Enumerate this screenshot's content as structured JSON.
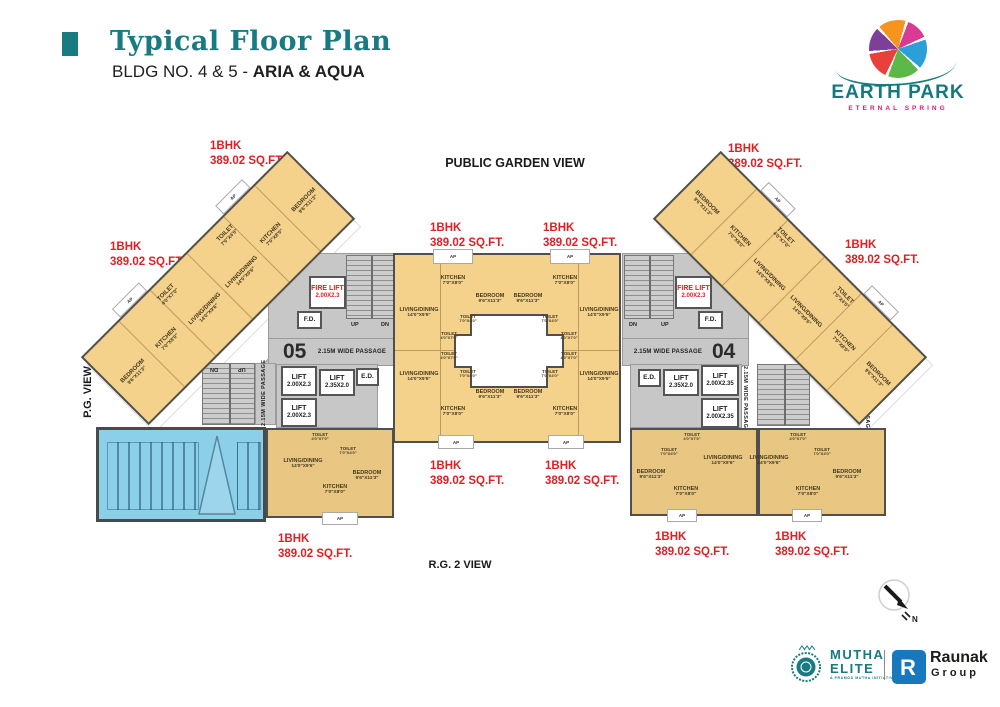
{
  "header": {
    "title": "Typical Floor Plan",
    "subtitle_prefix": "BLDG NO. 4 & 5 - ",
    "subtitle_bold": "ARIA & AQUA"
  },
  "brand": {
    "name": "EARTH PARK",
    "tagline": "ETERNAL SPRING"
  },
  "views": {
    "top": "PUBLIC GARDEN VIEW",
    "left": "P.G. VIEW",
    "bottom": "R.G. 2 VIEW"
  },
  "unit_label": {
    "type": "1BHK",
    "area": "389.02 SQ.FT."
  },
  "rooms": {
    "kitchen": {
      "name": "KITCHEN",
      "dims": "7'0\"X8'0\""
    },
    "bedroom": {
      "name": "BEDROOM",
      "dims": "9'6\"X11'3\""
    },
    "living": {
      "name": "LIVING/DINING",
      "dims": "14'0\"X9'6\""
    },
    "toilet_h": {
      "name": "TOILET",
      "dims": "7'0\"X4'0\""
    },
    "toilet_v": {
      "name": "TOILET",
      "dims": "4'0\"X7'0\""
    }
  },
  "core": {
    "fire_lift": "FIRE LIFT",
    "fire_lift_dims": "2.00X2.3",
    "fd": "F.D.",
    "ed": "E.D.",
    "lift": "LIFT",
    "lift_a": "2.00X2.3",
    "lift_b": "2.35X2.0",
    "lift_c": "2.00X2.35",
    "passage": "2.15M WIDE PASSAGE",
    "up": "UP",
    "dn": "DN",
    "bldg_left": "05",
    "bldg_right": "04",
    "ap": "AP"
  },
  "unit_numbers": [
    "01",
    "02"
  ],
  "compass": {
    "n": "N"
  },
  "footer": {
    "mutha_line1": "MUTHA",
    "mutha_line2": "ELITE",
    "mutha_tagline": "A PRAMOD MUTHA INITIATIVE",
    "raunak_line1": "Raunak",
    "raunak_line2": "Group"
  },
  "colors": {
    "teal": "#177B81",
    "red": "#E01F24",
    "room_fill": "#F5D28C",
    "core_fill": "#C7C7C7",
    "pool_fill": "#8CCFE9",
    "wall": "#4F4F4F",
    "raunak_blue": "#1878BD",
    "pink": "#E21776"
  }
}
